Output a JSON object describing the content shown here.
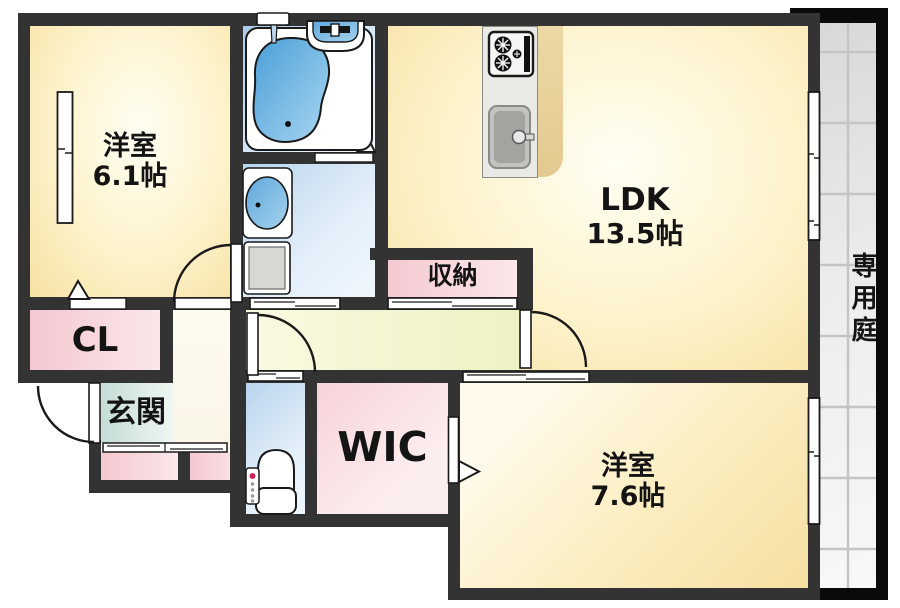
{
  "floorplan": {
    "rooms": {
      "bedroom1": {
        "name": "洋室",
        "size": "6.1帖"
      },
      "ldk": {
        "name": "LDK",
        "size": "13.5帖"
      },
      "storage": {
        "name": "収納"
      },
      "closet": {
        "name": "CL"
      },
      "entrance": {
        "name": "玄関"
      },
      "wic": {
        "name": "WIC"
      },
      "bedroom2": {
        "name": "洋室",
        "size": "7.6帖"
      },
      "garden": {
        "name": "専用庭"
      }
    },
    "fixtures": [
      "bathtub",
      "shower-head",
      "vanity-sink",
      "washbasin",
      "washing-machine-pan",
      "toilet",
      "gas-stove",
      "kitchen-sink"
    ],
    "colors": {
      "wall": "#333333",
      "outer_border": "#0a0a0a",
      "floor_cream": "#f8e3a6",
      "wet_area_blue": "#b5d3ee",
      "storage_pink": "#f3c9d0",
      "entrance_teal": "#c8ded9",
      "corridor_green": "#eef2c2",
      "garden_tile": "#e3e3e3",
      "fixture_blue": "#4a9fd8"
    }
  }
}
